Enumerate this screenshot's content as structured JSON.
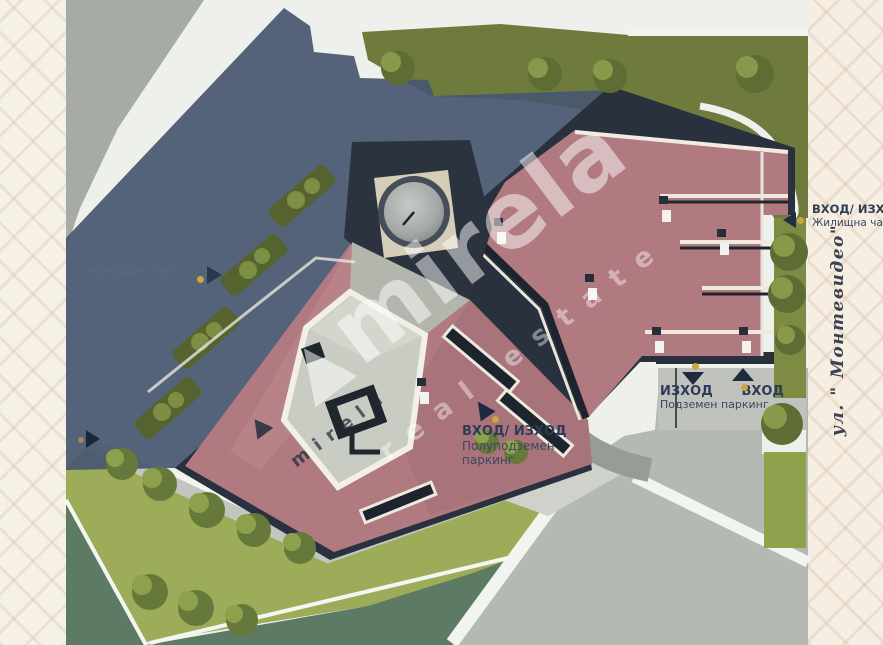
{
  "scene": {
    "description": "Aerial 3D site plan rendering of a residential complex with pink roofs, roof gardens, lawns and parking entrances"
  },
  "annotations": {
    "residential_left": {
      "title": "ВХОД/ ИЗХОД",
      "subtitle": "Жилищна част"
    },
    "residential_right": {
      "title": "ВХОД/ ИЗХОД",
      "subtitle": "Жилищна част"
    },
    "semi_underground": {
      "title": "ВХОД/ ИЗХОД",
      "line2": "Полуподземен",
      "line3": "паркинг"
    },
    "underground": {
      "exit": "ИЗХОД",
      "entrance": "ВХОД",
      "caption": "Подземен паркинг"
    }
  },
  "street": {
    "name": "ул. \" Монтевидео\""
  },
  "watermark": {
    "brand": "mirela",
    "tagline": "real estate",
    "brand_small": "mirela"
  },
  "colors": {
    "roof_pink": "#b17a80",
    "shadow_blue": "#47576f",
    "lawn_green": "#9dac58",
    "roof_garden_olive": "#6e7b3d",
    "dark_structure": "#28313d",
    "accent_gold": "#c9a83d",
    "label_navy": "#2e3b57",
    "border_cream": "#f6f1e6"
  }
}
